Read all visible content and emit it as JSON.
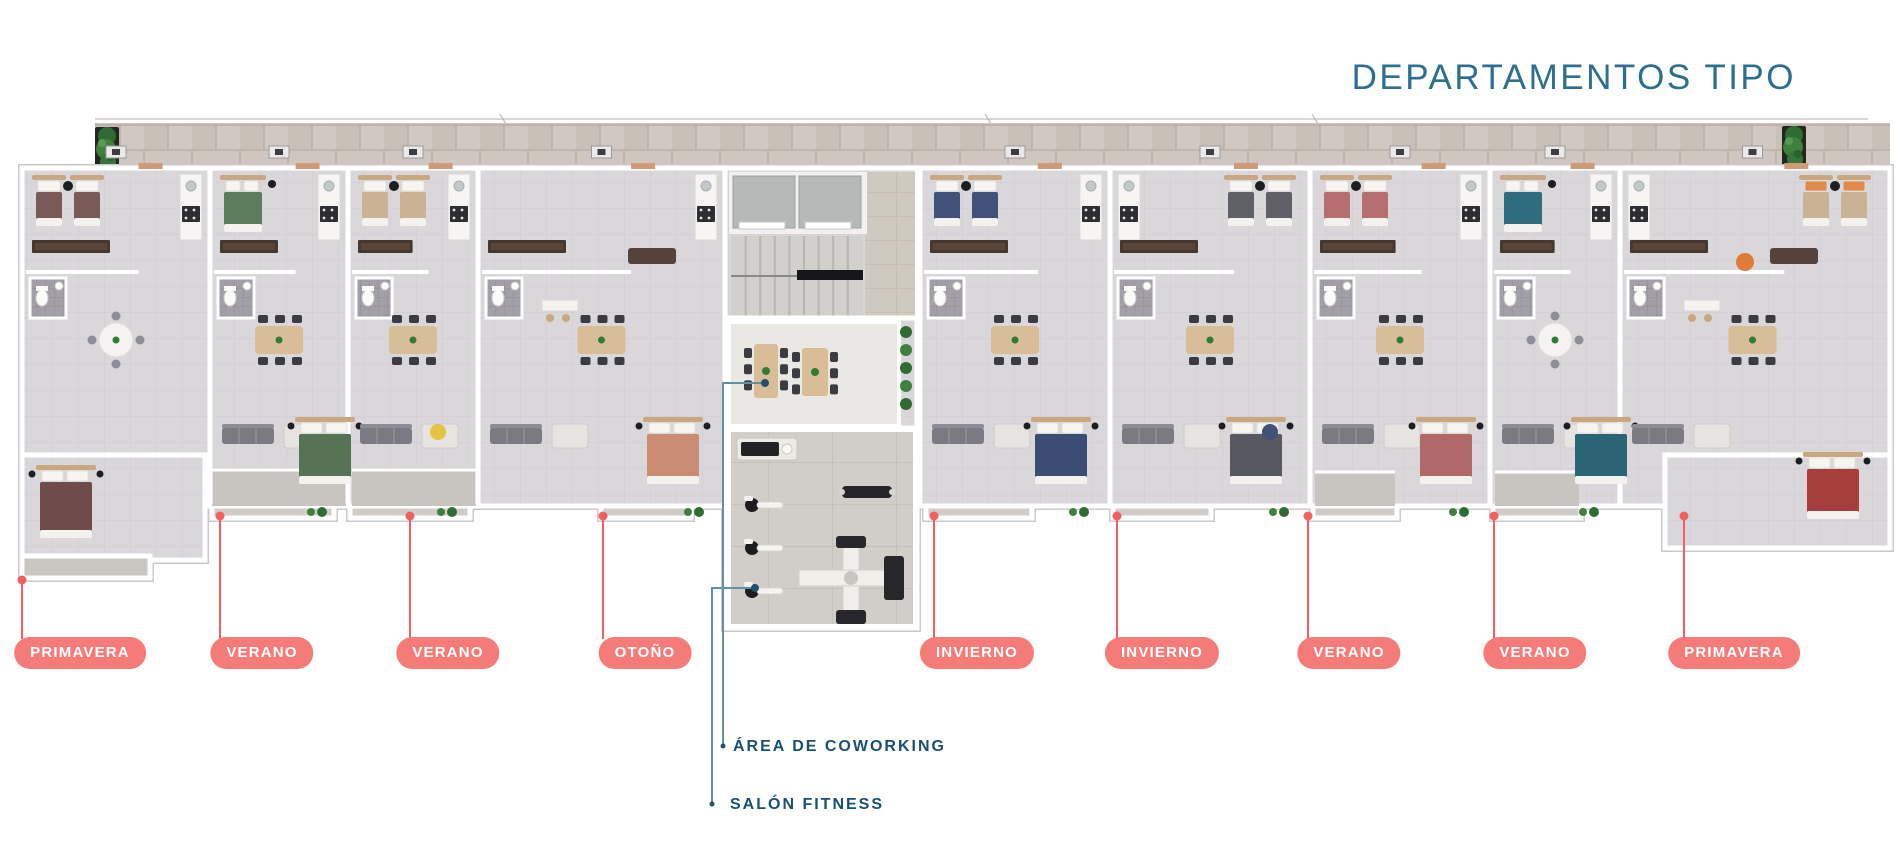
{
  "title": "DEPARTAMENTOS TIPO",
  "callouts": {
    "units": [
      {
        "label": "PRIMAVERA",
        "pill_x": 80,
        "pill_y": 637,
        "line_x": 22,
        "dot_y": 580
      },
      {
        "label": "VERANO",
        "pill_x": 262,
        "pill_y": 637,
        "line_x": 220,
        "dot_y": 516
      },
      {
        "label": "VERANO",
        "pill_x": 448,
        "pill_y": 637,
        "line_x": 410,
        "dot_y": 516
      },
      {
        "label": "OTOÑO",
        "pill_x": 645,
        "pill_y": 637,
        "line_x": 603,
        "dot_y": 516
      },
      {
        "label": "INVIERNO",
        "pill_x": 977,
        "pill_y": 637,
        "line_x": 934,
        "dot_y": 516
      },
      {
        "label": "INVIERNO",
        "pill_x": 1162,
        "pill_y": 637,
        "line_x": 1117,
        "dot_y": 516
      },
      {
        "label": "VERANO",
        "pill_x": 1349,
        "pill_y": 637,
        "line_x": 1308,
        "dot_y": 516
      },
      {
        "label": "VERANO",
        "pill_x": 1535,
        "pill_y": 637,
        "line_x": 1494,
        "dot_y": 516
      },
      {
        "label": "PRIMAVERA",
        "pill_x": 1734,
        "pill_y": 637,
        "line_x": 1684,
        "dot_y": 516
      }
    ],
    "amenities": [
      {
        "label": "ÁREA DE COWORKING",
        "anchor_x": 765,
        "anchor_y": 383,
        "elbow_x": 723,
        "end_y": 746,
        "label_x": 733,
        "label_y": 738
      },
      {
        "label": "SALÓN FITNESS",
        "anchor_x": 755,
        "anchor_y": 588,
        "elbow_x": 712,
        "end_y": 804,
        "label_x": 730,
        "label_y": 796
      }
    ]
  },
  "colors": {
    "title_text": "#2d6f90",
    "pill_bg": "#f57b79",
    "pill_text": "#ffffff",
    "leader_red": "#f2605e",
    "leader_teal": "#6391a3",
    "amenity_text": "#175070"
  }
}
